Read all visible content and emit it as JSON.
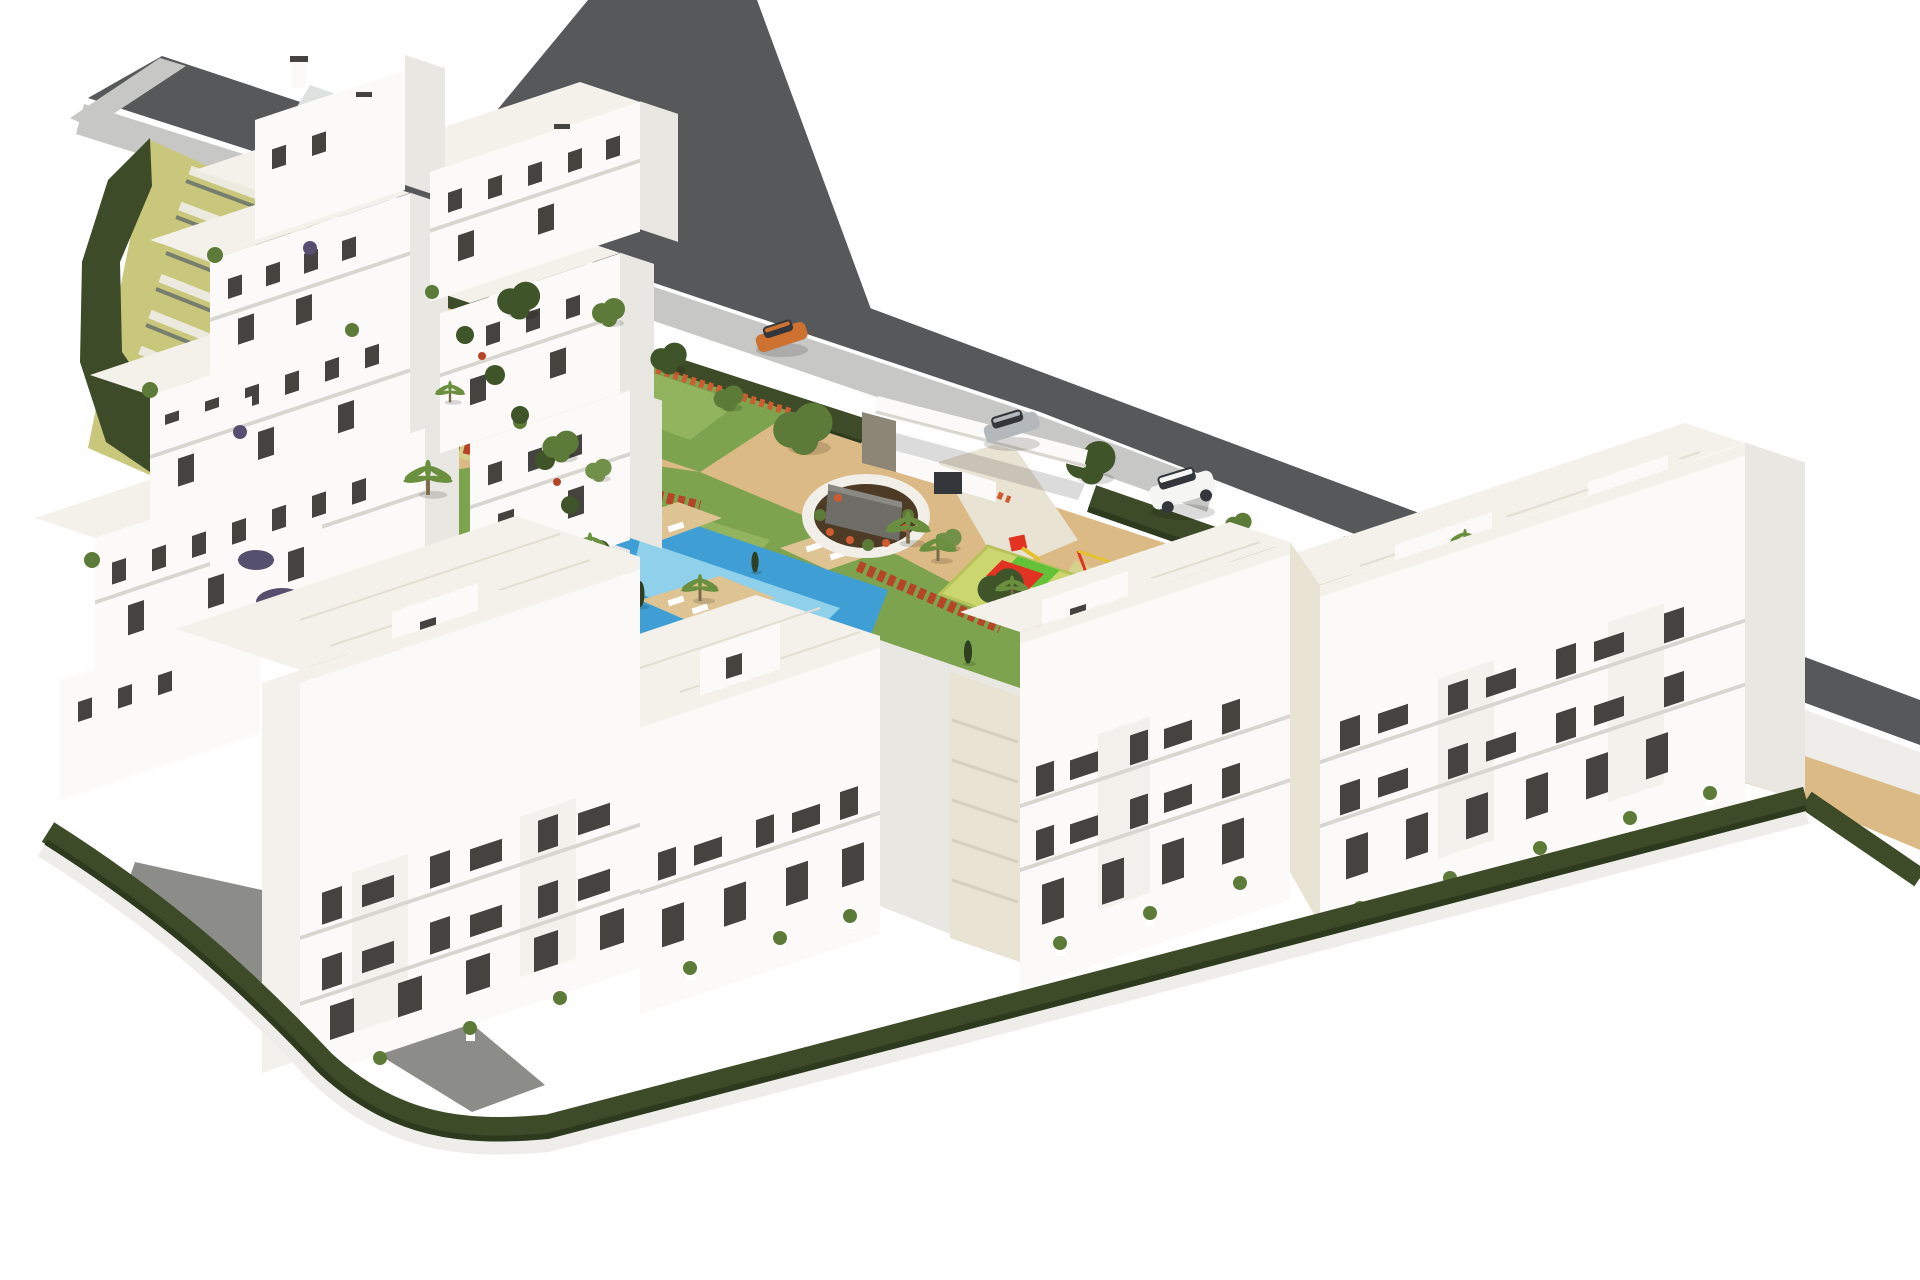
{
  "alt": "Aerial 3D architectural rendering of a white residential apartment complex: terraced apartment buildings on the left, a central garden with zig-zag swimming pool, lawns, palm trees, a children's playground with red mats, a circular planter with a sign monument, an entrance gate with canopy, a gray perimeter road with three cars (orange, silver, white), dark green boundary hedges and sandy courtyards, three white apartment blocks in the foreground.",
  "labels": {
    "scene": "Residential complex rendering",
    "road": "Perimeter road",
    "road_branch": "Road branch",
    "sidewalk": "Sidewalk",
    "roadside_hedge": "Roadside hedge",
    "stairs": "Terraced staircase garden",
    "cluster": "Terraced apartment cluster",
    "garden": "Central garden",
    "pool": "Swimming pool",
    "kids_pool": "Children's pool",
    "deck": "Pool deck",
    "pergola": "Pergola walkway",
    "roundabout": "Circular planter with monument sign",
    "playground": "Children's playground",
    "entrance": "Entrance gate with canopy",
    "car_orange": "Orange car",
    "car_silver": "Silver car",
    "car_white": "White SUV",
    "block_a": "Apartment block A",
    "block_b": "Apartment block B",
    "block_c": "Apartment block C",
    "courtyard": "Sandy courtyard",
    "boundary_hedge": "Boundary hedge",
    "shadow_slope": "Shaded slope"
  },
  "colors": {
    "bg": "#ffffff",
    "road": "#57585a",
    "sidewalk": "#c7c7c5",
    "wall": "#eeedea",
    "hedge": "#3e4b28",
    "hedge_dark": "#2e3a1e",
    "bank": "#c9c77c",
    "stairs_tread": "#eceade",
    "stairs_shadow": "#767e6e",
    "ramp": "#dde2e1",
    "building_white": "#fbfaf8",
    "building_shade": "#e9e7e1",
    "building_shade2": "#f3f1ec",
    "roof_light": "#f3f1ea",
    "roof_tile_line": "#e2ded2",
    "window_dark": "#45433f",
    "railing": "#d8d6d0",
    "sand": "#dcba85",
    "sand_light": "#e7cda2",
    "path_yellow": "#d5d28c",
    "lawn": "#7da34e",
    "lawn_light": "#93b45e",
    "pool": "#3f9fd4",
    "pool_light": "#8fd0ea",
    "deck": "#dfc493",
    "pergola": "#f6f4ef",
    "stone": "#e9e3d3",
    "step_line": "#d6cfbf",
    "flower_red": "#b64527",
    "flower_red2": "#cf5c31",
    "tree_dark": "#3f5428",
    "tree_mid": "#5c7a38",
    "tree_light": "#71914a",
    "palm_green": "#6a8f3e",
    "trunk": "#7c6b4a",
    "cypress": "#2f4022",
    "shrub_purple": "#565070",
    "play_mat": "#ccd66f",
    "play_red": "#e23322",
    "play_green": "#63c238",
    "play_yellow": "#e4c22e",
    "car_orange": "#cd7231",
    "car_silver": "#b3b8bd",
    "car_white": "#f5f5f4",
    "car_glass": "#33373b",
    "shadow": "#8c8c89",
    "soil": "#4d3b26",
    "monument": "#6e6d68",
    "ring_white": "#f1efe8",
    "soft": "rgba(0,0,0,0.14)"
  }
}
